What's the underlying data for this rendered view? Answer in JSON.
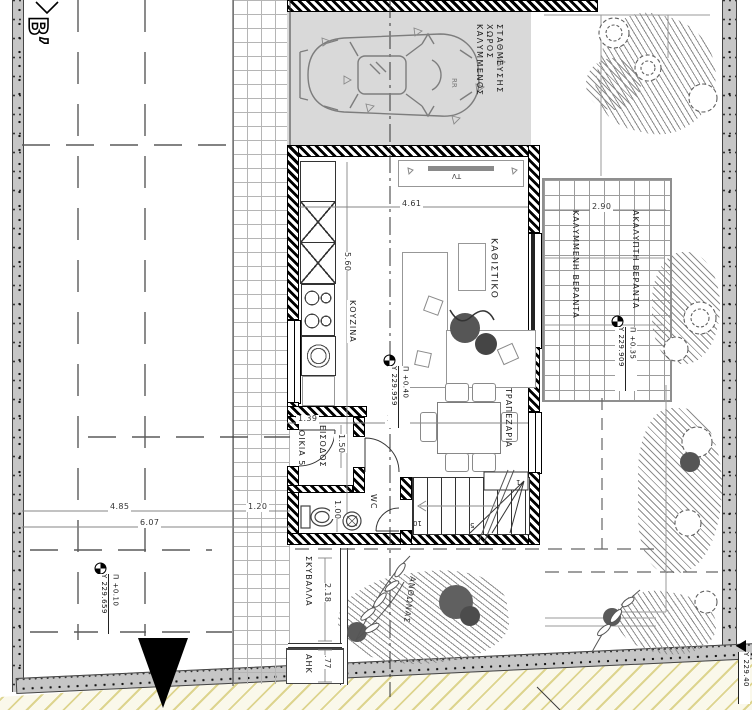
{
  "plan": {
    "section_marker": "Β’",
    "parking_label": "ΚΑΛΥΜΜΕΝΟΣ ΧΩΡΟΣ ΣΤΑΘΜΕΥΣΗΣ",
    "rooms": {
      "living": "ΚΑΘΙΣΤΙΚΟ",
      "kitchen": "ΚΟΥΖΙΝΑ",
      "dining": "ΤΡΑΠΕΖΑΡΙΑ",
      "entrance": "ΕΙΣΟΔΟΣ",
      "house": "ΟΙΚΙΑ 5",
      "wc": "WC",
      "tv": "TV",
      "car_badge": "RR"
    },
    "outdoor": {
      "covered_veranda": "ΚΑΛΥΜΜΕΝΗ ΒΕΡΑΝΤΑ",
      "uncovered_veranda": "ΑΚΑΛΥΠΤΗ ΒΕΡΑΝΤΑ",
      "garbage": "ΣΚΥΒΑΛΛΑ",
      "utility": "ΑΗΚ",
      "flowerbed": "ΑΝΘΩΝΑΣ"
    },
    "dims": {
      "living_w": "4.61",
      "kitchen_h": "5.60",
      "veranda_w": "2.90",
      "entry_w": "1.39",
      "dining_w": "3.82",
      "entry_d": "1.50",
      "walk_w": "1.20",
      "yard_a": "4.85",
      "yard_b": "6.07",
      "wc_w": "1.00",
      "garbage_h": "2.18",
      "utility_h": ".77"
    },
    "levels": {
      "living_p": "Π +0.40",
      "living_y": "Υ 229.959",
      "veranda_p": "Π +0.35",
      "veranda_y": "Υ 229.909",
      "yard_p": "Π +0.10",
      "yard_y": "Υ 229.659",
      "road_y": "Υ 229.40"
    },
    "stairs": {
      "n1": "1",
      "n5": "5",
      "n10": "10"
    }
  }
}
